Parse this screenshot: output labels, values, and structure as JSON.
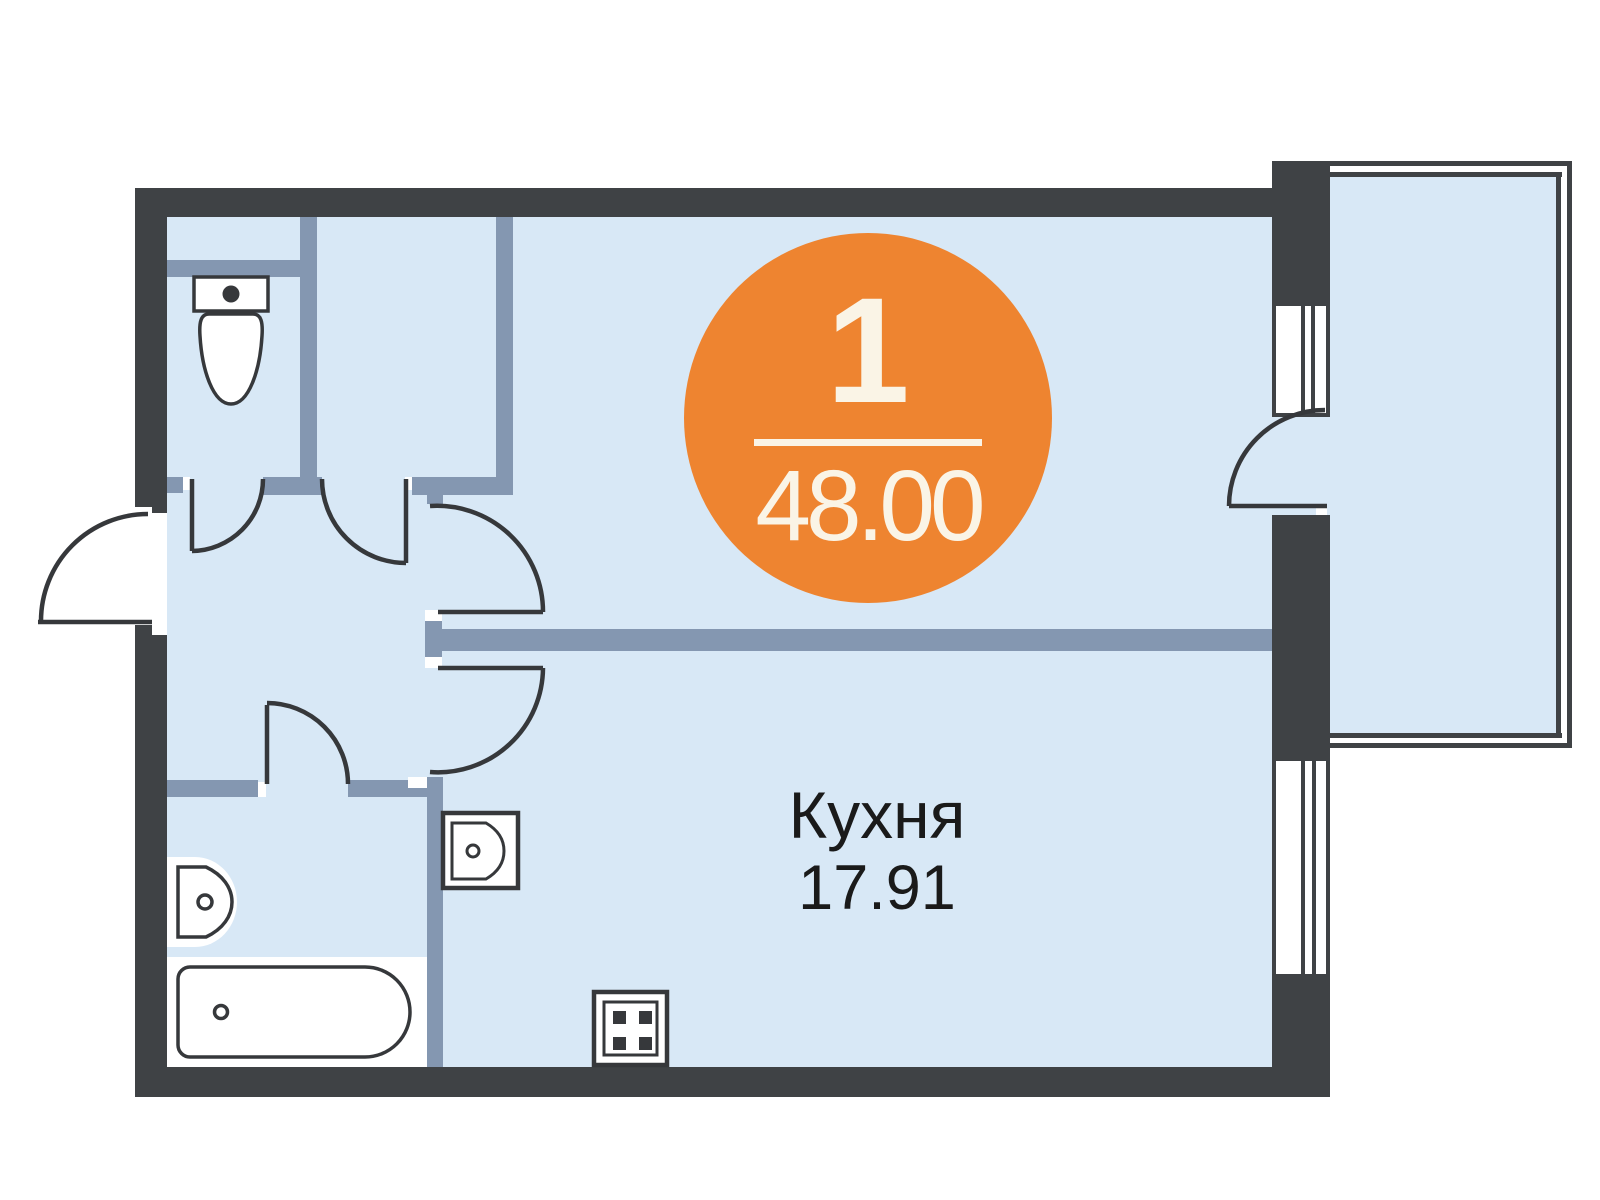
{
  "badge": {
    "rooms_count": "1",
    "total_area": "48.00"
  },
  "rooms": {
    "kitchen": {
      "label": "Кухня",
      "area": "17.91"
    }
  },
  "fixtures": [
    "toilet",
    "bathroom-sink",
    "bathtub",
    "kitchen-sink",
    "stove"
  ],
  "colors": {
    "accent_orange": "#EE8430",
    "badge_text": "#FAF4E6",
    "floor_fill": "#D8E8F6",
    "interior_wall": "#8497B1",
    "outer_wall": "#3F4245",
    "label_text": "#1A1A1A"
  }
}
